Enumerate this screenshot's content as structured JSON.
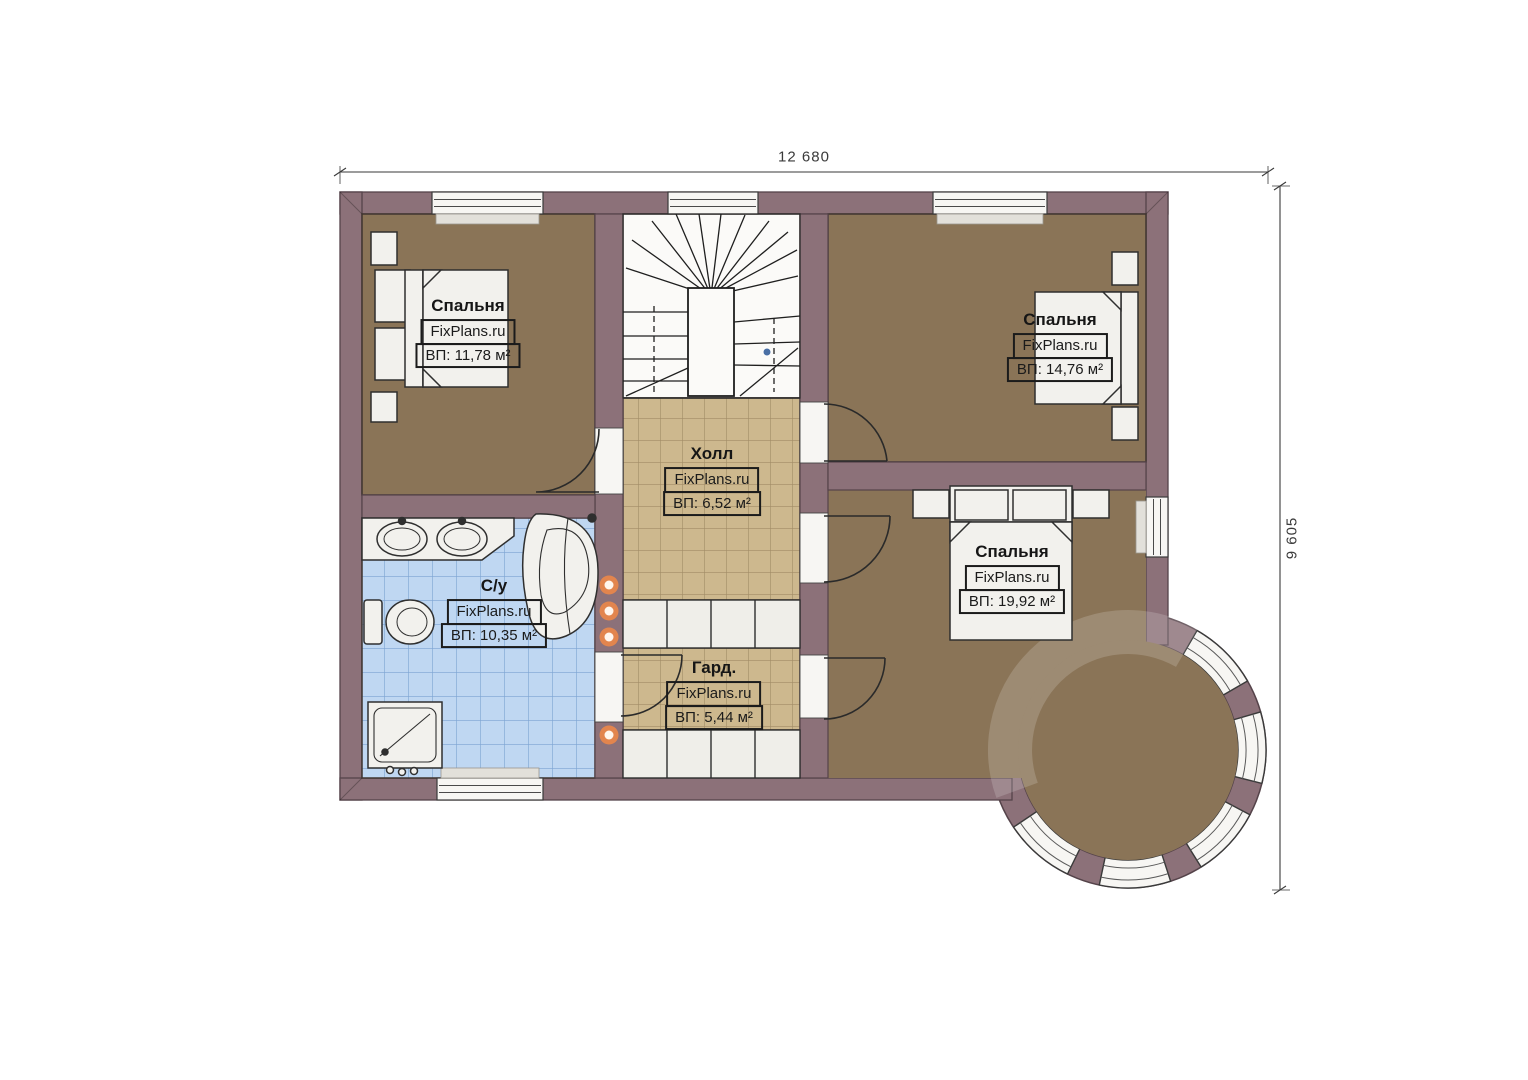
{
  "plan": {
    "type": "floor-plan",
    "watermark": "FixPlans.ru",
    "dimensions": {
      "width_label": "12 680",
      "height_label": "9 605"
    },
    "rooms": [
      {
        "id": "bedroom-1",
        "name": "Спальня",
        "brand": "FixPlans.ru",
        "area": "ВП: 11,78 м²"
      },
      {
        "id": "bedroom-2",
        "name": "Спальня",
        "brand": "FixPlans.ru",
        "area": "ВП: 14,76 м²"
      },
      {
        "id": "bedroom-3",
        "name": "Спальня",
        "brand": "FixPlans.ru",
        "area": "ВП: 19,92 м²"
      },
      {
        "id": "hall",
        "name": "Холл",
        "brand": "FixPlans.ru",
        "area": "ВП: 6,52 м²"
      },
      {
        "id": "bathroom",
        "name": "С/у",
        "brand": "FixPlans.ru",
        "area": "ВП: 10,35 м²"
      },
      {
        "id": "wardrobe",
        "name": "Гард.",
        "brand": "FixPlans.ru",
        "area": "ВП: 5,44 м²"
      }
    ],
    "colors": {
      "wall": "#8C7179",
      "bedroom_floor": "#8A7457",
      "hall_tile": "#CDB88E",
      "bath_tile": "#BFD7F2",
      "accent_dot": "#E2854E",
      "stair_marker": "#4A6FA5"
    }
  }
}
